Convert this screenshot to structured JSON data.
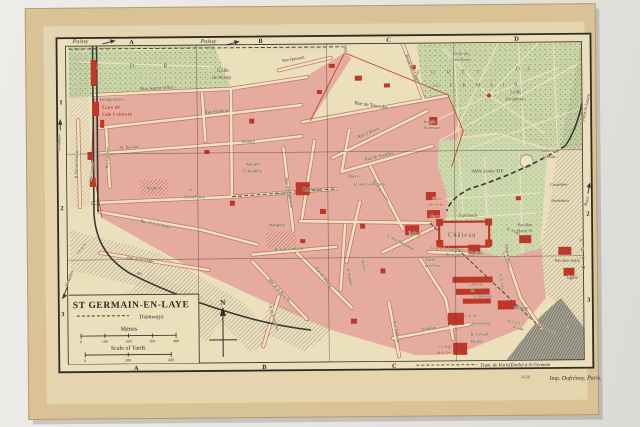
{
  "photo": {
    "description": "vintage 1924 city map of Saint-Germain-en-Laye photographed on a light background",
    "colors": {
      "paper": "#d8c296",
      "map_cream": "#ecdfbc",
      "town_pink": "#e5ab9e",
      "building_red": "#bc3828",
      "forest_green": "#ccd6a9",
      "ink": "#3a382f",
      "red_text": "#b03024",
      "forest_ink": "#53604a"
    }
  },
  "map": {
    "legend": {
      "title": "ST GERMAIN-EN-LAYE",
      "tramways_label": "Tramways",
      "metres_label": "Mètres",
      "metres_ticks": [
        "0",
        "100",
        "200",
        "300",
        "400"
      ],
      "yards_label": "Scale of Yards",
      "yards_ticks": [
        "0",
        "200",
        "400"
      ],
      "north_label": "N"
    },
    "grid": {
      "top": [
        {
          "l": "A",
          "x": 133
        },
        {
          "l": "B",
          "x": 262
        },
        {
          "l": "C",
          "x": 390
        },
        {
          "l": "D",
          "x": 518
        }
      ],
      "bottom": [
        {
          "l": "A",
          "x": 135
        },
        {
          "l": "B",
          "x": 263
        },
        {
          "l": "C",
          "x": 393
        }
      ],
      "left": [
        {
          "l": "1",
          "y": 100
        },
        {
          "l": "2",
          "y": 206
        },
        {
          "l": "3",
          "y": 312
        }
      ],
      "right": [
        {
          "l": "2",
          "y": 216
        },
        {
          "l": "3",
          "y": 302
        }
      ]
    },
    "credits": {
      "tram_caption": "Tram. de Paris(Étoile) à St Germain",
      "plate_number": "4-24",
      "printer": "Imp. Dufrénoy, Paris."
    },
    "labels": [
      {
        "t": "Poissy",
        "x": 82,
        "y": 41,
        "s": 6,
        "i": 1
      },
      {
        "t": "Poissy",
        "x": 210,
        "y": 42,
        "s": 6,
        "i": 1
      },
      {
        "t": "F O R",
        "x": 140,
        "y": 66,
        "s": 6,
        "i": 1,
        "sp": 14,
        "c": "g"
      },
      {
        "t": "F O R Ê T",
        "x": 452,
        "y": 75,
        "s": 5.5,
        "sp": 5,
        "c": "g"
      },
      {
        "t": "D E",
        "x": 526,
        "y": 72,
        "s": 5.5,
        "sp": 3,
        "c": "g"
      },
      {
        "t": "S T",
        "x": 432,
        "y": 88,
        "s": 5,
        "sp": 2,
        "c": "g"
      },
      {
        "t": "G E R M A I N",
        "x": 480,
        "y": 88,
        "s": 5.5,
        "sp": 4,
        "c": "g"
      },
      {
        "t": "Grille",
        "x": 224,
        "y": 71,
        "s": 5
      },
      {
        "t": "de Poissy",
        "x": 223,
        "y": 78,
        "s": 5
      },
      {
        "t": "Rue Jeanne d'Arc",
        "x": 158,
        "y": 88,
        "s": 4.8,
        "r": -2
      },
      {
        "t": "Porte(piétons)",
        "x": 113,
        "y": 99,
        "s": 4.4
      },
      {
        "t": "Gare de",
        "x": 112,
        "y": 107,
        "s": 5.2,
        "c": "r",
        "b": 1
      },
      {
        "t": "Gde Ceinture",
        "x": 118,
        "y": 114,
        "s": 5.2,
        "c": "r",
        "b": 1
      },
      {
        "t": "Rue Franklin",
        "x": 218,
        "y": 112,
        "s": 4.8,
        "r": -4
      },
      {
        "t": "R. Pereire",
        "x": 130,
        "y": 147,
        "s": 4.6,
        "r": -3
      },
      {
        "t": "Pereire",
        "x": 249,
        "y": 142,
        "s": 4.6,
        "r": -2
      },
      {
        "t": "Étoile",
        "x": 348,
        "y": 50,
        "s": 4.2,
        "r": -90
      },
      {
        "t": "Rue de Tourville",
        "x": 372,
        "y": 107,
        "s": 5,
        "r": 9
      },
      {
        "t": "Route des Loges",
        "x": 412,
        "y": 70,
        "s": 4.5,
        "r": 68
      },
      {
        "t": "Rue Quinault",
        "x": 295,
        "y": 60,
        "s": 4.2,
        "r": -8
      },
      {
        "t": "Étoile des",
        "x": 463,
        "y": 56,
        "s": 3.8
      },
      {
        "t": "Neuf Routes",
        "x": 463,
        "y": 62,
        "s": 3.8
      },
      {
        "t": "Grille",
        "x": 517,
        "y": 95,
        "s": 4.6
      },
      {
        "t": "Dauphine",
        "x": 516,
        "y": 102,
        "s": 4.6
      },
      {
        "t": "Paris St Lazare",
        "x": 588,
        "y": 110,
        "s": 4.4,
        "r": -78,
        "i": 1
      },
      {
        "t": "Ancien",
        "x": 253,
        "y": 165,
        "s": 4.8
      },
      {
        "t": "Cimetière",
        "x": 253,
        "y": 172,
        "s": 4.8
      },
      {
        "t": "Collège",
        "x": 311,
        "y": 191,
        "s": 5.4
      },
      {
        "t": "Thiers",
        "x": 353,
        "y": 178,
        "s": 4.6
      },
      {
        "t": "Pl. des Combattants",
        "x": 370,
        "y": 186,
        "s": 4
      },
      {
        "t": "Rue de Noailles",
        "x": 380,
        "y": 158,
        "s": 4.6,
        "r": -13
      },
      {
        "t": "R. de Lorraine",
        "x": 380,
        "y": 192,
        "s": 4.2,
        "r": 56
      },
      {
        "t": "Rue d'Alsace",
        "x": 370,
        "y": 134,
        "s": 4.6,
        "r": -23
      },
      {
        "t": "Rue d'Hennemont",
        "x": 288,
        "y": 193,
        "s": 4.2,
        "r": 79
      },
      {
        "t": "Temple",
        "x": 430,
        "y": 124,
        "s": 4.2
      },
      {
        "t": "Protestant",
        "x": 433,
        "y": 130,
        "s": 4.2
      },
      {
        "t": "Hôtel",
        "x": 437,
        "y": 201,
        "s": 4.4,
        "c": "r"
      },
      {
        "t": "de Ville",
        "x": 436,
        "y": 207,
        "s": 4.4,
        "c": "r"
      },
      {
        "t": "Gare",
        "x": 435,
        "y": 219,
        "s": 5.2,
        "c": "r",
        "b": 1
      },
      {
        "t": "Esplanade",
        "x": 468,
        "y": 218,
        "s": 4.6,
        "i": 1
      },
      {
        "t": "Église",
        "x": 414,
        "y": 236,
        "s": 5
      },
      {
        "t": "Château",
        "x": 462,
        "y": 238,
        "s": 6.5,
        "sp": 1
      },
      {
        "t": "R. de la République",
        "x": 400,
        "y": 244,
        "s": 3.8,
        "r": 28
      },
      {
        "t": "R. de la Surintendance",
        "x": 447,
        "y": 251,
        "s": 3.6,
        "r": 4
      },
      {
        "t": "Berteaux",
        "x": 453,
        "y": 257,
        "s": 4.2
      },
      {
        "t": "Théâtre",
        "x": 476,
        "y": 256,
        "s": 4.8
      },
      {
        "t": "Salle",
        "x": 430,
        "y": 262,
        "s": 4.2
      },
      {
        "t": "des Fêtes",
        "x": 432,
        "y": 268,
        "s": 4.2
      },
      {
        "t": "Allée Louis XIV",
        "x": 488,
        "y": 174,
        "s": 5,
        "i": 1
      },
      {
        "t": "Pavillon",
        "x": 525,
        "y": 228,
        "s": 4.4
      },
      {
        "t": "Henri IV",
        "x": 525,
        "y": 234,
        "s": 4.4
      },
      {
        "t": "Petite Terrasse",
        "x": 506,
        "y": 258,
        "s": 4.2,
        "r": 85
      },
      {
        "t": "du Pecq et",
        "x": 550,
        "y": 154,
        "s": 3.8
      },
      {
        "t": "la Grille",
        "x": 550,
        "y": 160,
        "s": 3.8
      },
      {
        "t": "Cimetière",
        "x": 559,
        "y": 188,
        "s": 4.4
      },
      {
        "t": "Ascenseur",
        "x": 560,
        "y": 204,
        "s": 4.4
      },
      {
        "t": "Rueil",
        "x": 588,
        "y": 204,
        "s": 4.4,
        "r": -72,
        "i": 1
      },
      {
        "t": "Pavillon Sully",
        "x": 567,
        "y": 264,
        "s": 4.4
      },
      {
        "t": "Église",
        "x": 572,
        "y": 281,
        "s": 4.4
      },
      {
        "t": "P",
        "x": 581,
        "y": 244,
        "s": 4.6,
        "i": 1
      },
      {
        "t": "E",
        "x": 582,
        "y": 253,
        "s": 4.6,
        "i": 1
      },
      {
        "t": "C",
        "x": 583,
        "y": 262,
        "s": 4.6,
        "i": 1
      },
      {
        "t": "Q",
        "x": 583,
        "y": 271,
        "s": 4.6,
        "i": 1
      },
      {
        "t": "L",
        "x": 563,
        "y": 322,
        "s": 4.6,
        "i": 1
      },
      {
        "t": "E",
        "x": 566,
        "y": 331,
        "s": 4.6,
        "i": 1
      },
      {
        "t": "R. Thiers",
        "x": 513,
        "y": 234,
        "s": 3.8,
        "r": 22
      },
      {
        "t": "R. de Sully",
        "x": 500,
        "y": 284,
        "s": 3.6,
        "r": 80
      },
      {
        "t": "Caserne",
        "x": 475,
        "y": 287,
        "s": 4.4
      },
      {
        "t": "de",
        "x": 472,
        "y": 293,
        "s": 4.4
      },
      {
        "t": "Grammont",
        "x": 482,
        "y": 299,
        "s": 4.4
      },
      {
        "t": "Manège",
        "x": 520,
        "y": 311,
        "s": 4.4
      },
      {
        "t": "Cas. de",
        "x": 470,
        "y": 318,
        "s": 4
      },
      {
        "t": "Luxembourg",
        "x": 479,
        "y": 326,
        "s": 4
      },
      {
        "t": "R. Croix",
        "x": 513,
        "y": 325,
        "s": 3.6,
        "r": 12
      },
      {
        "t": "Boissée",
        "x": 517,
        "y": 331,
        "s": 3.6,
        "r": 12
      },
      {
        "t": "R. de Pontoise",
        "x": 546,
        "y": 332,
        "s": 3.8,
        "r": 28
      },
      {
        "t": "R. Giraud-",
        "x": 479,
        "y": 337,
        "s": 4.4
      },
      {
        "t": "Teulon",
        "x": 475,
        "y": 344,
        "s": 4.4
      },
      {
        "t": "Collège",
        "x": 444,
        "y": 349,
        "s": 4.4,
        "c": "r"
      },
      {
        "t": "de Filles",
        "x": 443,
        "y": 355,
        "s": 4.4,
        "c": "r"
      },
      {
        "t": "Rue Diderot",
        "x": 394,
        "y": 332,
        "s": 4.4,
        "r": 80
      },
      {
        "t": "Voltaire",
        "x": 428,
        "y": 331,
        "s": 4.8,
        "r": -8
      },
      {
        "t": "Rue de Mareil",
        "x": 322,
        "y": 278,
        "s": 4.4,
        "r": 52
      },
      {
        "t": "R. Wauthier",
        "x": 348,
        "y": 278,
        "s": 3.8,
        "r": 78
      },
      {
        "t": "Marché",
        "x": 362,
        "y": 266,
        "s": 3.6,
        "r": 80
      },
      {
        "t": "Rue de la Bergette",
        "x": 278,
        "y": 291,
        "s": 4.2,
        "r": 48
      },
      {
        "t": "R. Gde Fontaine",
        "x": 289,
        "y": 250,
        "s": 4.4,
        "r": -3
      },
      {
        "t": "Hospice",
        "x": 277,
        "y": 226,
        "s": 4.8
      },
      {
        "t": "Désoyer",
        "x": 283,
        "y": 194,
        "s": 4.6,
        "r": -6
      },
      {
        "t": "Pl.",
        "x": 191,
        "y": 190,
        "s": 3.8
      },
      {
        "t": "Léon Passy",
        "x": 195,
        "y": 197,
        "s": 4.6
      },
      {
        "t": "Abattoir",
        "x": 154,
        "y": 188,
        "s": 4.6
      },
      {
        "t": "Rue de la Villette",
        "x": 155,
        "y": 224,
        "s": 4.4,
        "r": 13
      },
      {
        "t": "Rue de St Léger",
        "x": 140,
        "y": 259,
        "s": 4.2,
        "r": 10
      },
      {
        "t": "Ru",
        "x": 139,
        "y": 273,
        "s": 4,
        "i": 1
      },
      {
        "t": "R. de Fourqueux",
        "x": 272,
        "y": 318,
        "s": 3.8,
        "r": 73
      },
      {
        "t": "R. Bernard Palissy",
        "x": 78,
        "y": 162,
        "s": 3.8,
        "r": -88
      },
      {
        "t": "Gde Ceinture",
        "x": 93,
        "y": 170,
        "s": 3.6,
        "r": -84
      },
      {
        "t": "Rue Claperon",
        "x": 109,
        "y": 156,
        "s": 3.8,
        "r": -87
      },
      {
        "t": "A Mantes",
        "x": 61,
        "y": 140,
        "s": 4.4,
        "r": -90,
        "i": 1
      },
      {
        "t": "Versailles",
        "x": 70,
        "y": 277,
        "s": 4.4,
        "r": -68,
        "i": 1
      },
      {
        "t": "Ch. de fer",
        "x": 82,
        "y": 247,
        "s": 3.4,
        "r": -50
      }
    ]
  }
}
